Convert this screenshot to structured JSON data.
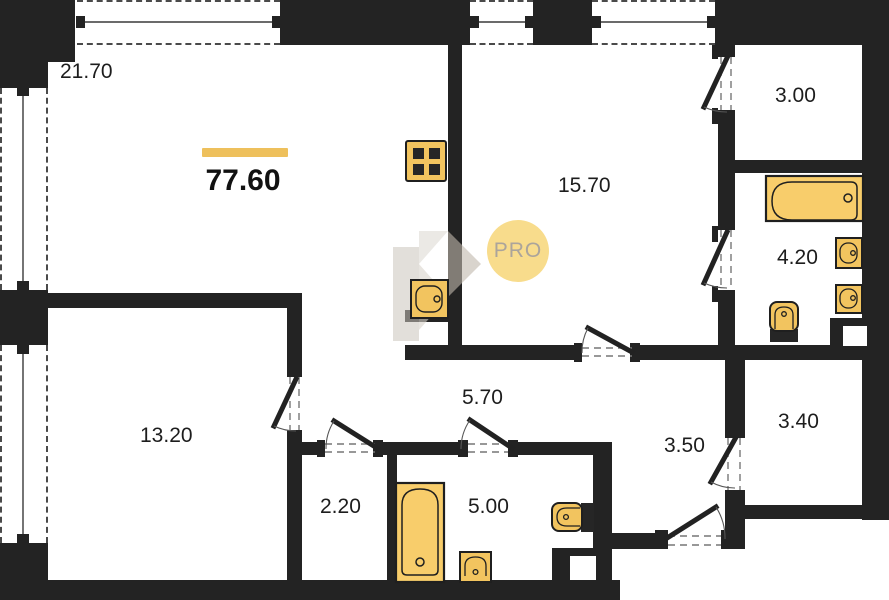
{
  "plan_type": "apartment-floor-plan",
  "total": {
    "area": "77.60"
  },
  "watermark": {
    "text": "PRO"
  },
  "rooms": [
    {
      "name": "living-kitchen",
      "area": "21.70"
    },
    {
      "name": "bedroom",
      "area": "15.70"
    },
    {
      "name": "dressing-top",
      "area": "3.00"
    },
    {
      "name": "bathroom",
      "area": "4.20"
    },
    {
      "name": "bedroom-2",
      "area": "13.20"
    },
    {
      "name": "hallway",
      "area": "5.70"
    },
    {
      "name": "wardrobe",
      "area": "2.20"
    },
    {
      "name": "bathroom-2",
      "area": "5.00"
    },
    {
      "name": "entry-hall",
      "area": "3.50"
    },
    {
      "name": "storage",
      "area": "3.40"
    }
  ],
  "fixtures": [
    "stove-icon",
    "kitchen-sink-icon",
    "bathtub-icon",
    "bathtub-vertical-icon",
    "wall-sink-icon",
    "wall-sink-icon",
    "toilet-icon",
    "toilet-icon",
    "sink-icon"
  ],
  "colors": {
    "wall": "#232323",
    "fixture_fill": "#F2C45F",
    "tub_fill": "#F8CD6B",
    "fixture_stroke": "#1f1f1f",
    "accent_bar": "#EEC05C",
    "watermark_circle": "#F8DC8C",
    "watermark_text": "#ABA49B"
  }
}
